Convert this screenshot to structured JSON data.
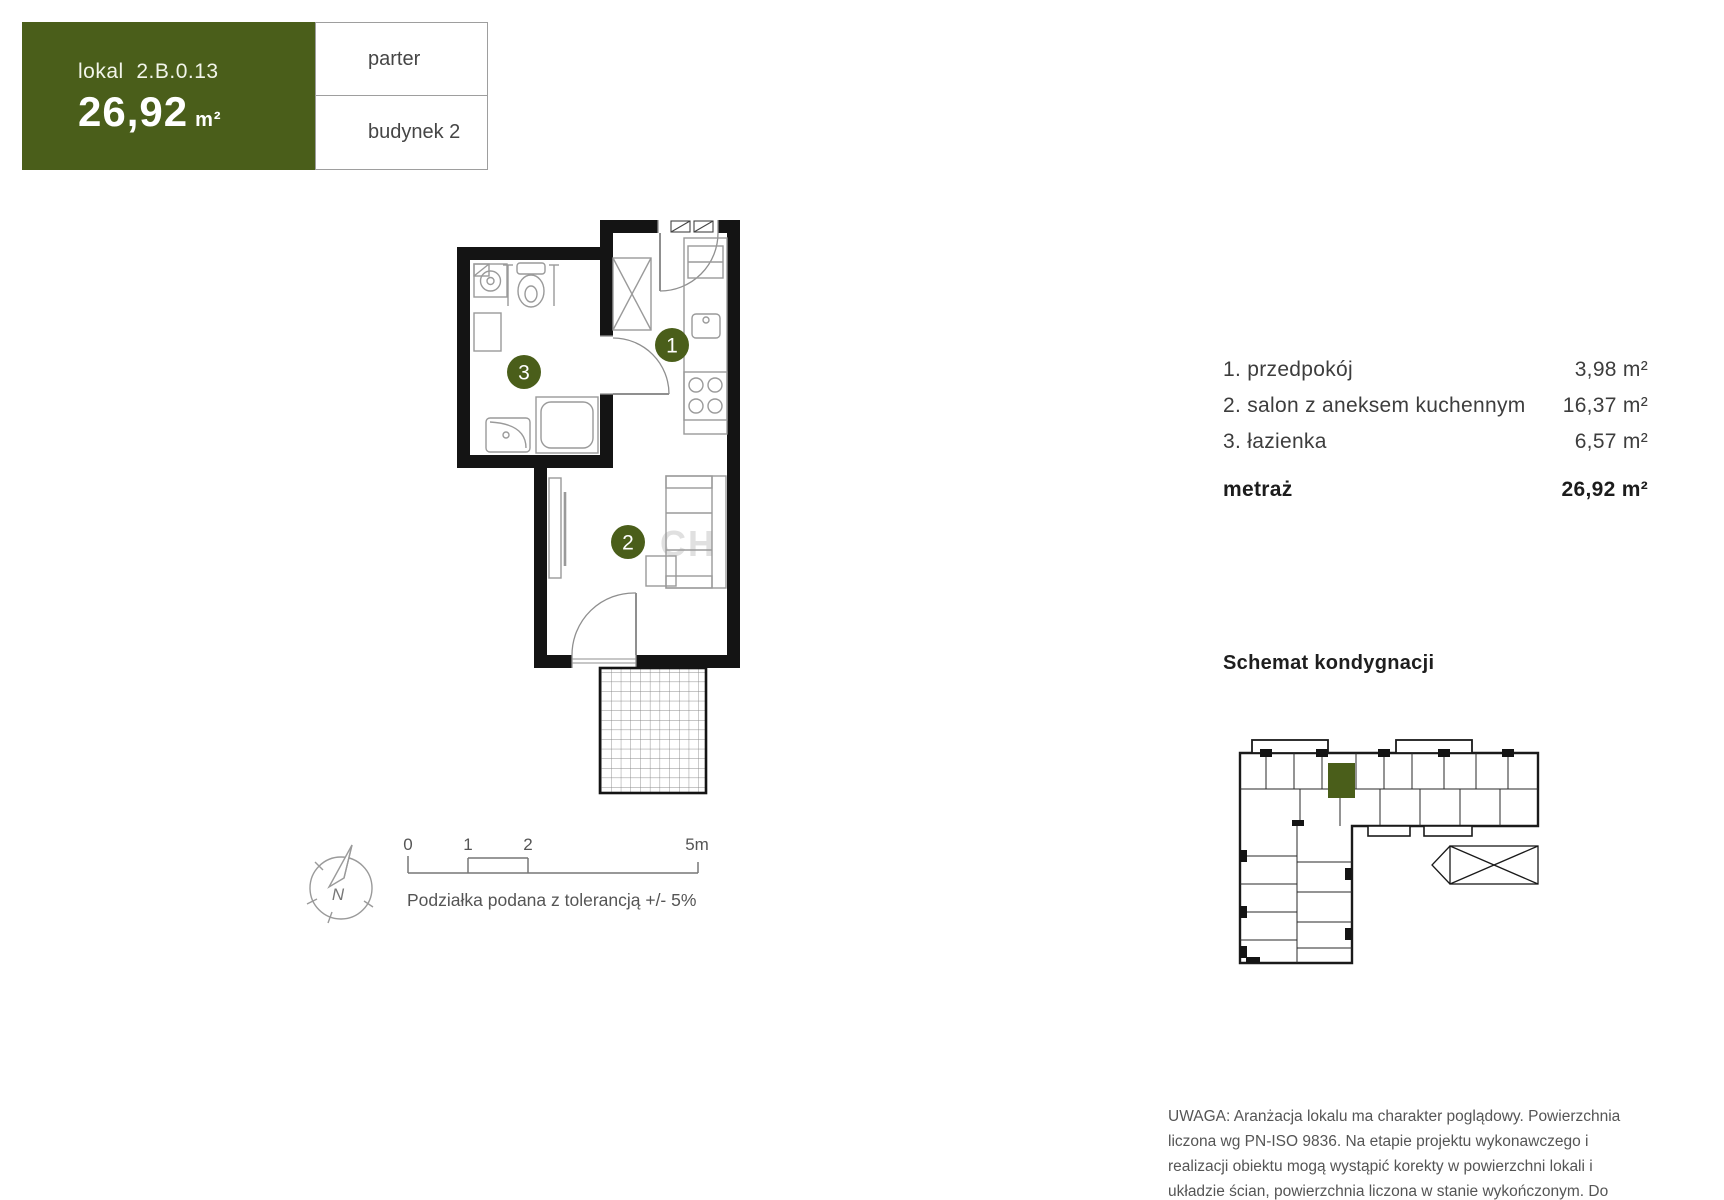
{
  "header": {
    "lokal_label": "lokal  2.B.0.13",
    "area_value": "26,92",
    "area_unit": "m²",
    "floor_label": "parter",
    "building_label": "budynek 2"
  },
  "plan": {
    "markers": [
      {
        "label": "1"
      },
      {
        "label": "2"
      },
      {
        "label": "3"
      }
    ],
    "watermark": "CH"
  },
  "legend": {
    "rooms": [
      {
        "name": "1. przedpokój",
        "area": "3,98 m²"
      },
      {
        "name": "2. salon z aneksem kuchennym",
        "area": "16,37 m²"
      },
      {
        "name": "3. łazienka",
        "area": "6,57 m²"
      }
    ],
    "total_label": "metraż",
    "total_area": "26,92 m²"
  },
  "scale_bar": {
    "tick0": "0",
    "tick1": "1",
    "tick2": "2",
    "tick5": "5m",
    "caption": "Podziałka podana z tolerancją +/- 5%"
  },
  "compass": {
    "north_label": "N"
  },
  "schematic": {
    "title": "Schemat kondygnacji"
  },
  "disclaimer": "UWAGA: Aranżacja lokalu ma charakter poglądowy. Powierzchnia liczona wg PN-ISO 9836. Na etapie projektu wykonawczego i realizacji obiektu mogą wystąpić korekty w powierzchni lokali i układzie ścian, powierzchnia liczona w stanie wykończonym. Do obliczeń przyjęto 1,5cm tynku.",
  "colors": {
    "accent": "#4A5E1A",
    "wall": "#141414"
  }
}
